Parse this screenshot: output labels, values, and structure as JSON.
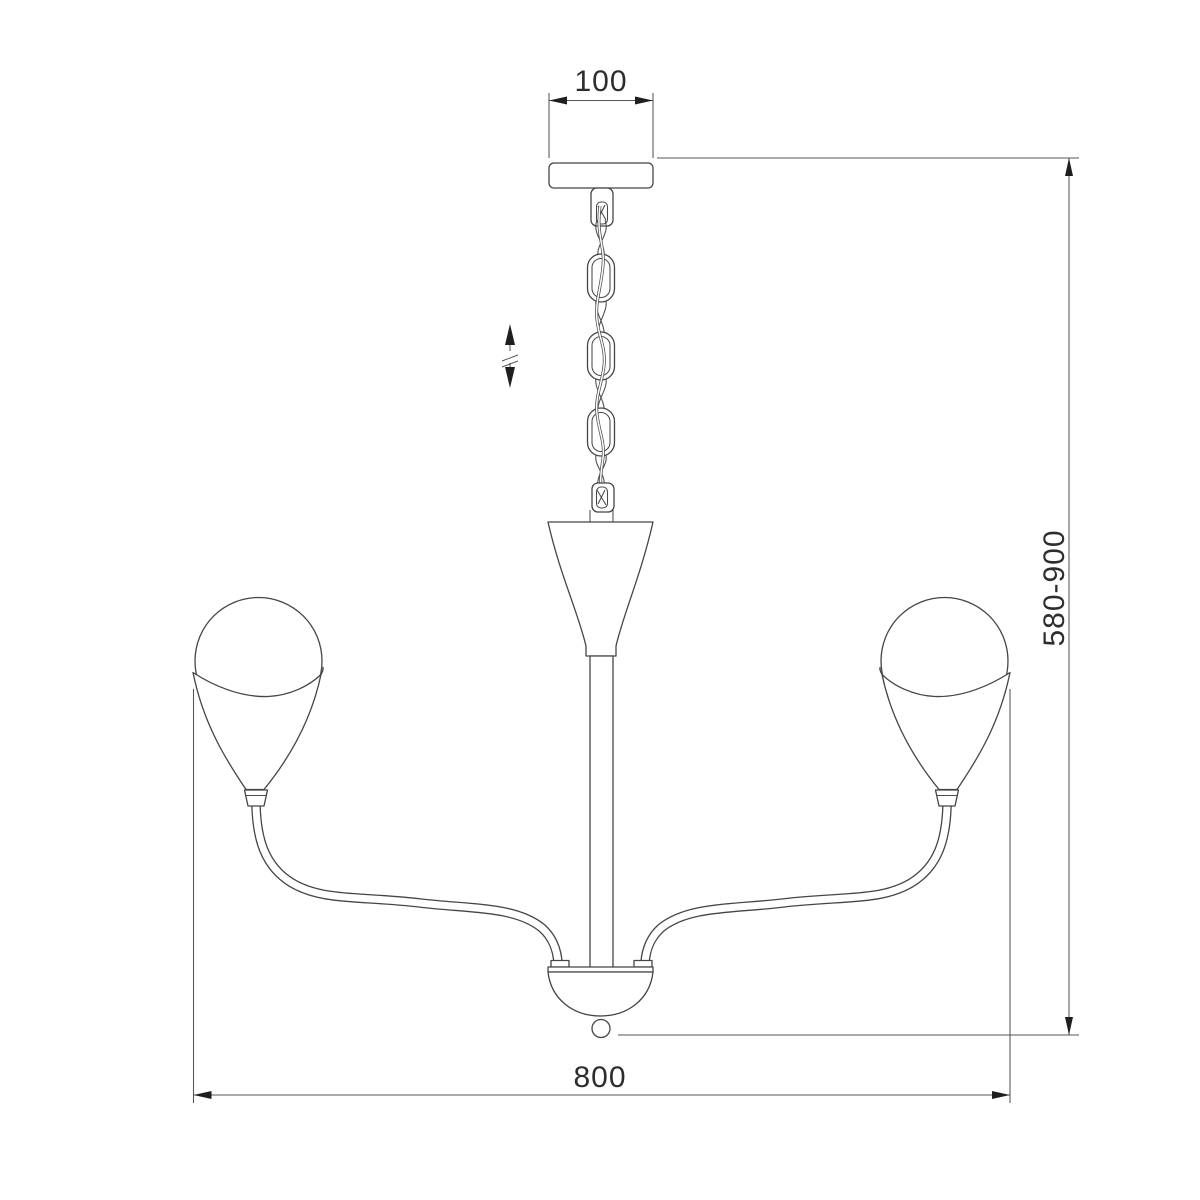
{
  "document": {
    "kind": "technical dimension drawing",
    "subject": "two-arm chandelier with chain suspension",
    "background": "#ffffff"
  },
  "colors": {
    "drawing_line": "#454545",
    "dimension_line": "#555555",
    "dimension_text": "#2d2d2d",
    "arrow_fill": "#1f1f1f"
  },
  "dimensions": {
    "canopy_width": {
      "label": "100"
    },
    "height_range": {
      "label": "580-900"
    },
    "overall_width": {
      "label": "800"
    }
  },
  "symbols": {
    "height_adjust_icon": "up-down-arrows-with-break-marks"
  }
}
